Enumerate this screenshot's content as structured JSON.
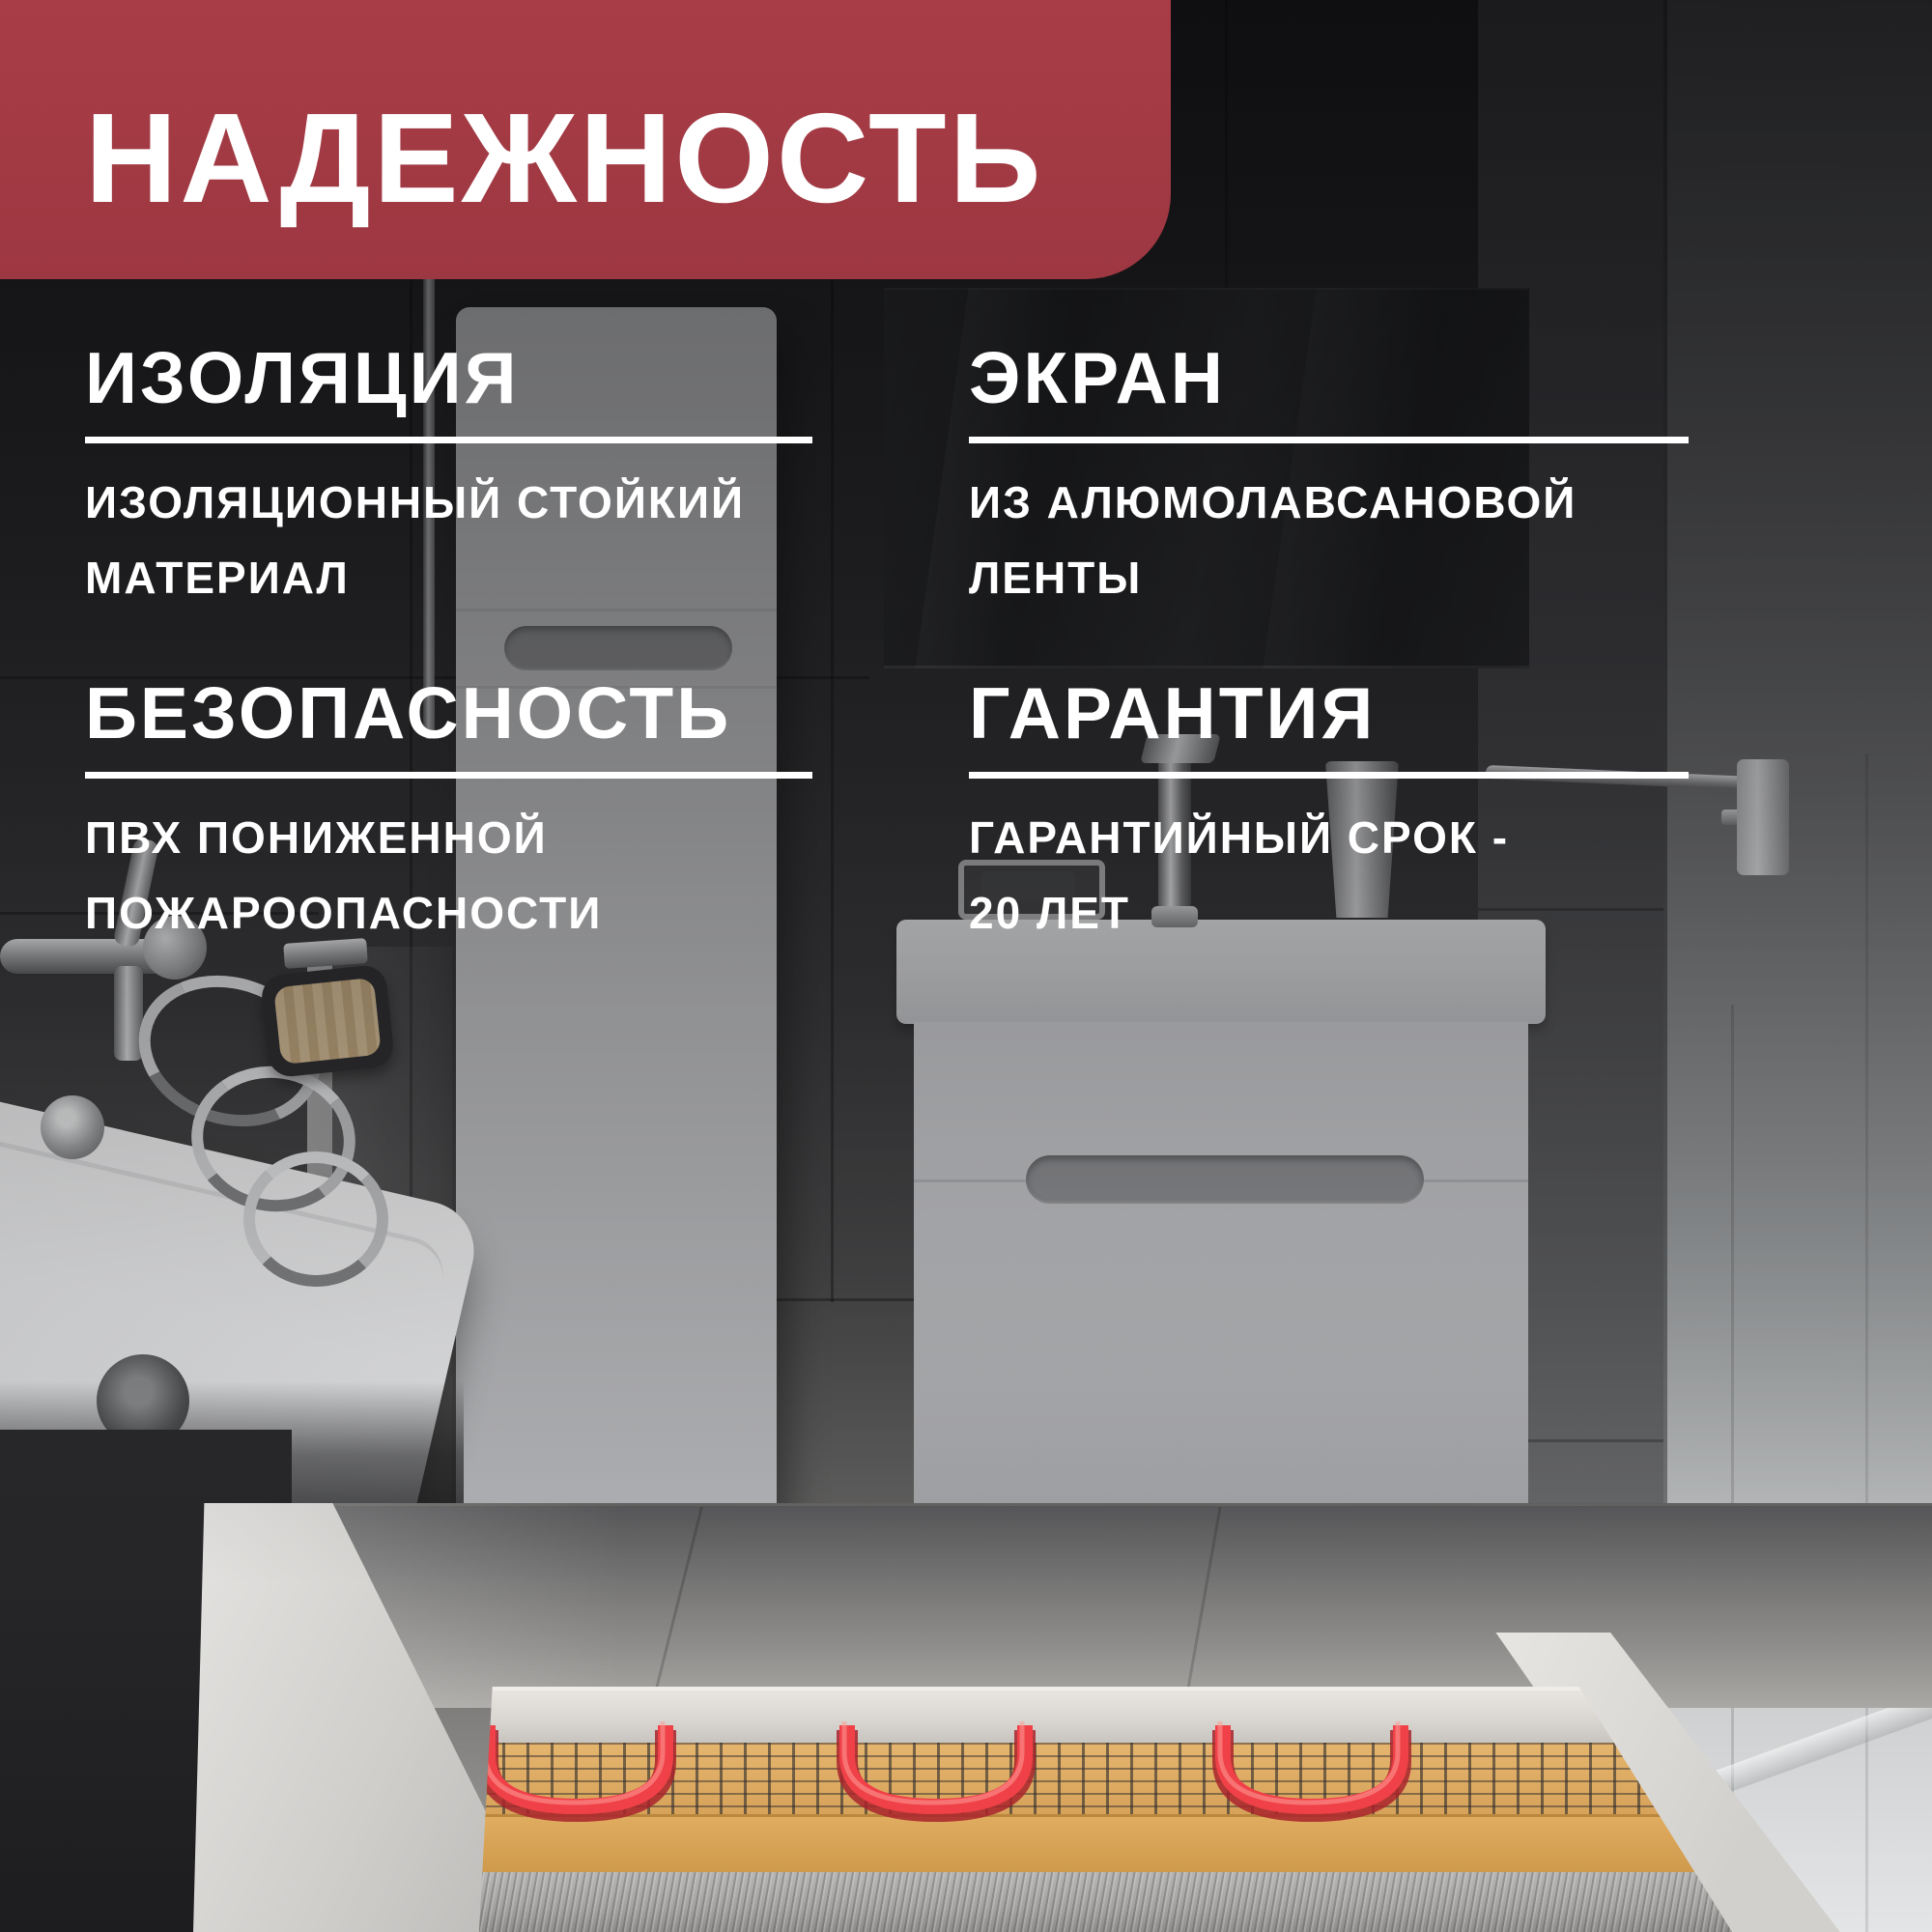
{
  "badge": {
    "label": "НАДЕЖНОСТЬ"
  },
  "sections": [
    {
      "id": "insulation",
      "title": "ИЗОЛЯЦИЯ",
      "lines": [
        "ИЗОЛЯЦИОННЫЙ СТОЙКИЙ",
        "МАТЕРИАЛ"
      ]
    },
    {
      "id": "screen",
      "title": "ЭКРАН",
      "lines": [
        "ИЗ АЛЮМОЛАВСАНОВОЙ",
        "ЛЕНТЫ"
      ]
    },
    {
      "id": "safety",
      "title": "БЕЗОПАСНОСТЬ",
      "lines": [
        "ПВХ ПОНИЖЕННОЙ",
        "ПОЖАРООПАСНОСТИ"
      ]
    },
    {
      "id": "warranty",
      "title": "ГАРАНТИЯ",
      "lines": [
        "ГАРАНТИЙНЫЙ СРОК -",
        "20 ЛЕТ"
      ]
    }
  ],
  "colors": {
    "accent_red": "#a33b44",
    "text": "#ffffff",
    "cable_red": "#ef4147",
    "mesh_tan": "#dcab62",
    "screed_tan": "#d8a458",
    "background_dark": "#2a2a2c"
  }
}
